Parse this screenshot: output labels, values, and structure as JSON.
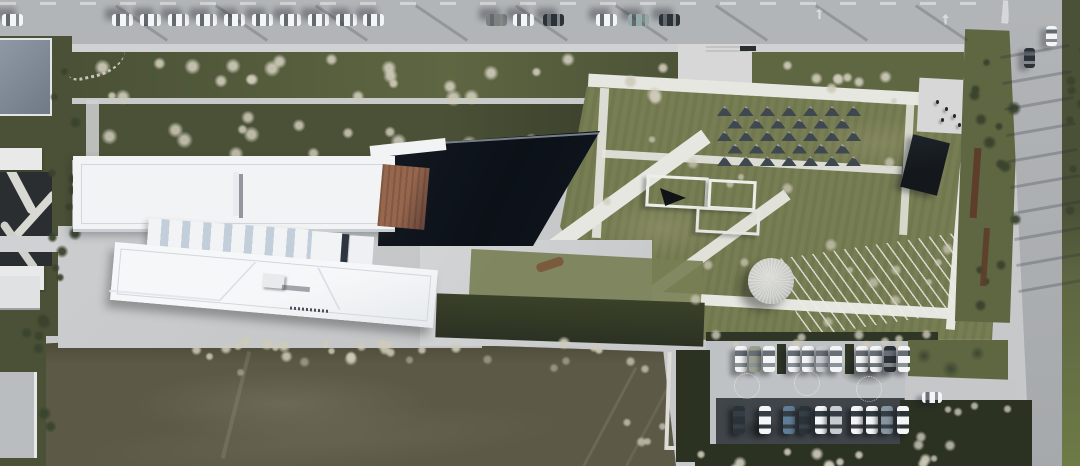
{
  "meta": {
    "type": "aerial-photograph",
    "subject": "top-down drone view of a museum campus in winter: white linear buildings with sawtooth skylights, copper roof wedge, dark triangular reflecting pool, geometric garden with triangular canopies and dome pavilion, roads with parked cars, double-row parking lot, bare earth field",
    "width": 1080,
    "height": 466
  },
  "palette": {
    "base": "#c6c8ca",
    "road": "#b2b5b7",
    "road_line": "#d9dbdc",
    "sidewalk": "#cfd1d2",
    "plaza": "#d6d7d6",
    "path": "#e7e7e2",
    "green_dark": "#4a5136",
    "green_mid": "#5e6642",
    "lawn": "#787e53",
    "lawn_dry": "#999872",
    "hedge": "#2f3626",
    "scrub_dark": "#2b3222",
    "pool": "#0c1118",
    "pool_rim": "#9aa3ac",
    "roof": "#f2f3f4",
    "roof_shade": "#c3cedb",
    "roof_line": "#d2d7dd",
    "copper": "#96664d",
    "copper_dark": "#66443a",
    "field": "#5c5947",
    "field_light": "#7a7664",
    "field_dark": "#454331",
    "asphalt": "#40454a",
    "dome": "#c6c8c3",
    "corten": "#5e3d2a",
    "bus": "#14181c",
    "tree_bare": "#cfcbba",
    "tree_ever": "#39432d",
    "car_white": "#f4f5f6",
    "car_silver": "#c7cbd0",
    "car_dark": "#2c3338",
    "car_blue": "#5f7d99",
    "car_teal": "#93aaa8",
    "car_olive": "#9aa08d",
    "car_gray": "#7e827e",
    "car_slate": "#8795a0",
    "glass": "rgba(45,55,65,0.6)",
    "glass_soft": "rgba(45,55,65,0.35)"
  },
  "car_rows": [
    {
      "name": "top-road-parked-car",
      "dir": "h",
      "w": 21,
      "h": 12,
      "y": 14,
      "shadow": "-7px -6px 6px rgba(25,30,40,0.35)",
      "cars": [
        {
          "x": 2,
          "c": "car_white"
        },
        {
          "x": 112,
          "c": "car_white"
        },
        {
          "x": 140,
          "c": "car_white"
        },
        {
          "x": 168,
          "c": "car_white"
        },
        {
          "x": 196,
          "c": "car_white"
        },
        {
          "x": 224,
          "c": "car_white"
        },
        {
          "x": 252,
          "c": "car_white"
        },
        {
          "x": 280,
          "c": "car_white"
        },
        {
          "x": 308,
          "c": "car_white"
        },
        {
          "x": 336,
          "c": "car_white"
        },
        {
          "x": 363,
          "c": "car_white"
        },
        {
          "x": 486,
          "c": "car_gray"
        },
        {
          "x": 513,
          "c": "car_white"
        },
        {
          "x": 543,
          "c": "car_dark"
        },
        {
          "x": 596,
          "c": "car_white"
        },
        {
          "x": 628,
          "c": "car_teal"
        },
        {
          "x": 659,
          "c": "car_dark"
        }
      ]
    },
    {
      "name": "east-road-moving-car",
      "dir": "v",
      "w": 11,
      "h": 20,
      "y": 0,
      "shadow": "-6px 3px 5px rgba(25,30,40,0.3)",
      "cars": [
        {
          "x": 1024,
          "y": 48,
          "c": "car_dark"
        },
        {
          "x": 1046,
          "y": 26,
          "c": "car_white"
        }
      ]
    },
    {
      "name": "parking-north-row-car",
      "dir": "v",
      "w": 12,
      "h": 26,
      "y": 346,
      "shadow": "-5px 4px 5px rgba(20,25,32,0.4)",
      "cars": [
        {
          "x": 735,
          "c": "car_white"
        },
        {
          "x": 749,
          "c": "car_olive"
        },
        {
          "x": 763,
          "c": "car_white"
        },
        {
          "x": 788,
          "c": "car_white"
        },
        {
          "x": 802,
          "c": "car_white"
        },
        {
          "x": 816,
          "c": "car_silver"
        },
        {
          "x": 830,
          "c": "car_white"
        },
        {
          "x": 856,
          "c": "car_white"
        },
        {
          "x": 870,
          "c": "car_white"
        },
        {
          "x": 884,
          "c": "car_dark"
        },
        {
          "x": 898,
          "c": "car_white"
        }
      ]
    },
    {
      "name": "parking-south-row-car",
      "dir": "v",
      "w": 12,
      "h": 28,
      "y": 406,
      "shadow": "-5px 3px 5px rgba(10,13,16,0.5)",
      "cars": [
        {
          "x": 733,
          "c": "car_dark"
        },
        {
          "x": 759,
          "c": "car_white"
        },
        {
          "x": 783,
          "c": "car_blue"
        },
        {
          "x": 799,
          "c": "car_dark"
        },
        {
          "x": 815,
          "c": "car_white"
        },
        {
          "x": 830,
          "c": "car_silver"
        },
        {
          "x": 851,
          "c": "car_white"
        },
        {
          "x": 866,
          "c": "car_white"
        },
        {
          "x": 881,
          "c": "car_slate"
        },
        {
          "x": 897,
          "c": "car_white"
        }
      ]
    },
    {
      "name": "parking-aisle-car",
      "dir": "h",
      "w": 20,
      "h": 11,
      "y": 392,
      "shadow": "-6px 4px 5px rgba(25,30,40,0.35)",
      "cars": [
        {
          "x": 922,
          "c": "car_white"
        }
      ]
    }
  ],
  "garden": {
    "canopy_grid": {
      "x": 717,
      "y": 106,
      "cols": 7,
      "rows": 5,
      "dx": 21.5,
      "dy": 12.5,
      "stagger": 10.5,
      "tri_w": 15,
      "tri_h": 10
    },
    "dome": {
      "x": 748,
      "y": 258,
      "d": 46
    },
    "people": [
      [
        936,
        100
      ],
      [
        945,
        107
      ],
      [
        953,
        114
      ],
      [
        941,
        118
      ],
      [
        958,
        123
      ]
    ],
    "ground_art_circles": [
      [
        746,
        385
      ],
      [
        806,
        382
      ],
      [
        868,
        388
      ]
    ]
  },
  "tree_bands": [
    {
      "x0": 70,
      "x1": 670,
      "y0": 52,
      "y1": 92,
      "n": 26,
      "type": "bare",
      "s0": 10,
      "s1": 18,
      "seed": 7,
      "op": 0.9
    },
    {
      "x0": 756,
      "x1": 900,
      "y0": 50,
      "y1": 88,
      "n": 8,
      "type": "bare",
      "s0": 10,
      "s1": 16,
      "seed": 11,
      "op": 0.9
    },
    {
      "x0": 76,
      "x1": 560,
      "y0": 106,
      "y1": 152,
      "n": 15,
      "type": "bare",
      "s0": 10,
      "s1": 18,
      "seed": 21,
      "op": 0.85
    },
    {
      "x0": 585,
      "x1": 950,
      "y0": 95,
      "y1": 320,
      "n": 20,
      "type": "bare",
      "s0": 8,
      "s1": 14,
      "seed": 31,
      "op": 0.7
    },
    {
      "x0": 125,
      "x1": 430,
      "y0": 336,
      "y1": 358,
      "n": 12,
      "type": "bare",
      "s0": 8,
      "s1": 14,
      "seed": 41,
      "op": 0.85
    },
    {
      "x0": 200,
      "x1": 655,
      "y0": 334,
      "y1": 352,
      "n": 11,
      "type": "bare",
      "s0": 9,
      "s1": 15,
      "seed": 51,
      "op": 0.9
    },
    {
      "x0": 700,
      "x1": 928,
      "y0": 326,
      "y1": 342,
      "n": 10,
      "type": "bare",
      "s0": 8,
      "s1": 13,
      "seed": 61,
      "op": 0.8
    },
    {
      "x0": 695,
      "x1": 930,
      "y0": 444,
      "y1": 464,
      "n": 11,
      "type": "bare",
      "s0": 9,
      "s1": 16,
      "seed": 71,
      "op": 0.9
    },
    {
      "x0": 968,
      "x1": 1012,
      "y0": 38,
      "y1": 300,
      "n": 14,
      "type": "ever",
      "s0": 9,
      "s1": 16,
      "seed": 81,
      "op": 0.95
    },
    {
      "x0": 1064,
      "x1": 1078,
      "y0": 0,
      "y1": 210,
      "n": 7,
      "type": "ever",
      "s0": 8,
      "s1": 13,
      "seed": 91,
      "op": 0.95
    },
    {
      "x0": 46,
      "x1": 70,
      "y0": 52,
      "y1": 330,
      "n": 12,
      "type": "ever",
      "s0": 9,
      "s1": 16,
      "seed": 101,
      "op": 0.95
    },
    {
      "x0": 2,
      "x1": 44,
      "y0": 298,
      "y1": 458,
      "n": 7,
      "type": "ever",
      "s0": 10,
      "s1": 16,
      "seed": 111,
      "op": 0.9
    },
    {
      "x0": 612,
      "x1": 660,
      "y0": 356,
      "y1": 440,
      "n": 6,
      "type": "bare",
      "s0": 9,
      "s1": 14,
      "seed": 121,
      "op": 0.75
    },
    {
      "x0": 905,
      "x1": 1005,
      "y0": 398,
      "y1": 462,
      "n": 8,
      "type": "bare",
      "s0": 8,
      "s1": 14,
      "seed": 131,
      "op": 0.8
    },
    {
      "x0": 230,
      "x1": 640,
      "y0": 352,
      "y1": 368,
      "n": 6,
      "type": "bare",
      "s0": 8,
      "s1": 12,
      "seed": 141,
      "op": 0.5
    }
  ],
  "streak_sets": [
    {
      "n": 9,
      "x0": 140,
      "dx": 100,
      "y0": -8,
      "dy": 0,
      "w": 3,
      "h": 62,
      "rot": -56,
      "color": "rgba(40,45,55,0.22)"
    },
    {
      "n": 10,
      "x0": 1000,
      "dx": 2,
      "y0": 50,
      "dy": 26,
      "w": 70,
      "h": 3,
      "rot": -10,
      "color": "rgba(40,45,55,0.25)"
    }
  ]
}
